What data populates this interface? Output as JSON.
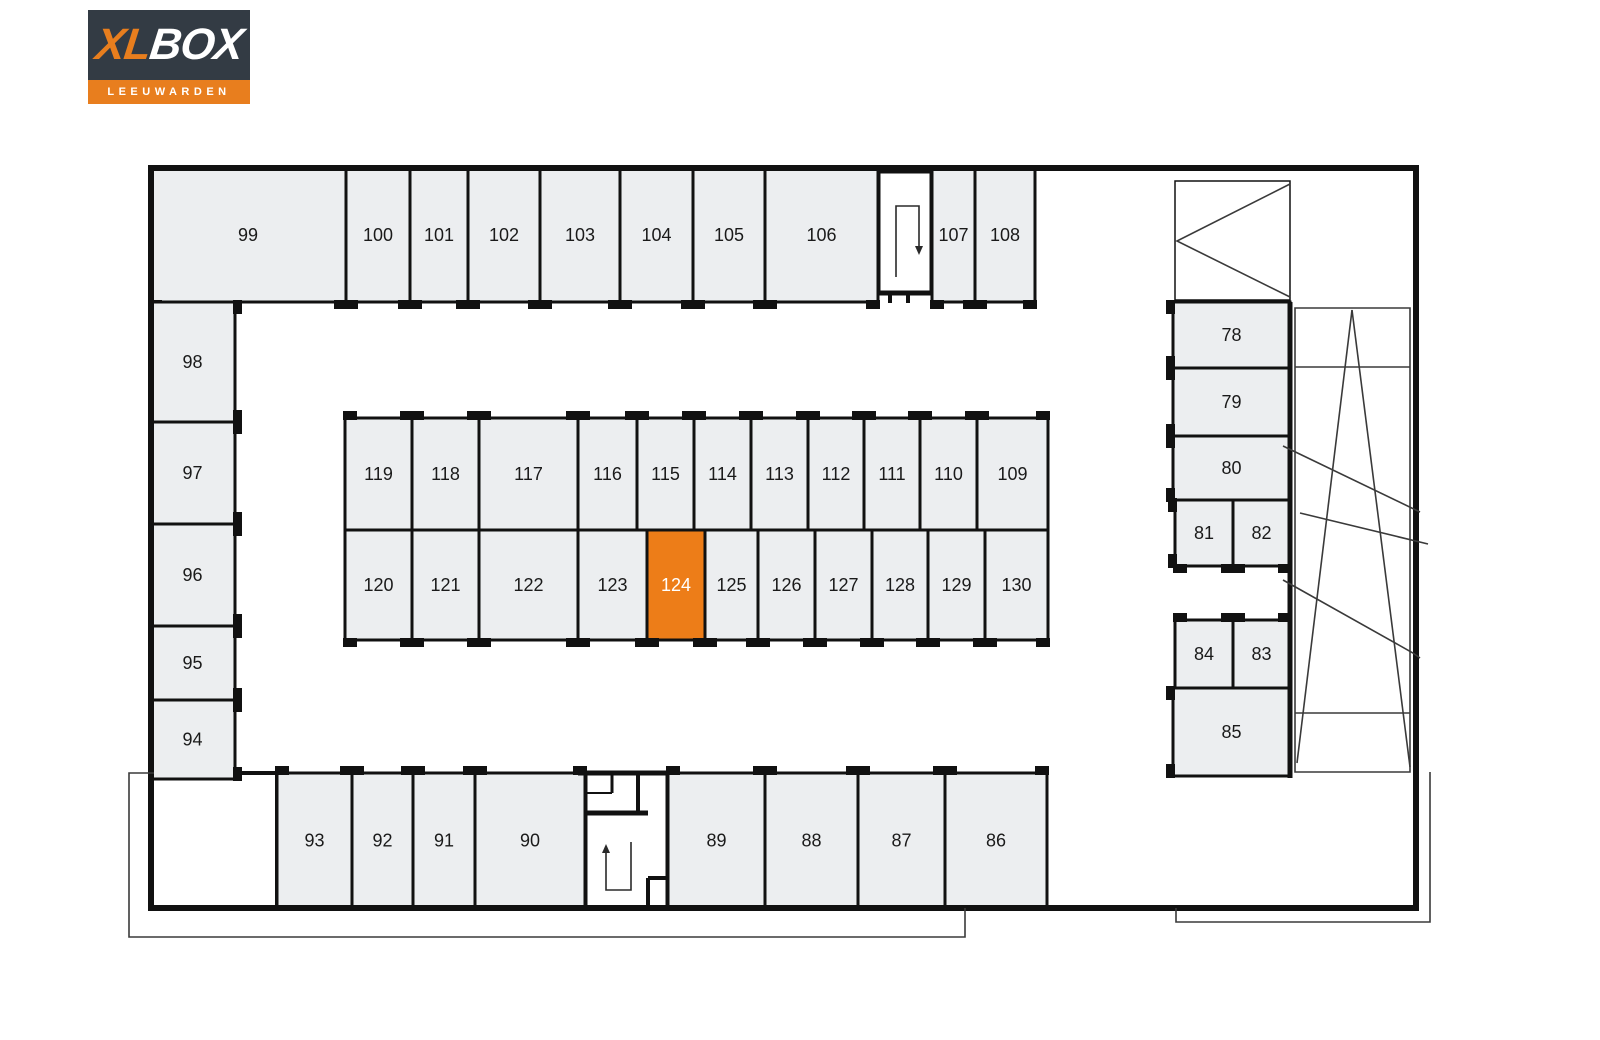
{
  "logo": {
    "xl": "XL",
    "box": "BOX",
    "city": "LEEUWARDEN",
    "dark_bg": "#333B44",
    "orange": "#E87E1E"
  },
  "colors": {
    "unit_fill": "#ECEEF0",
    "highlight_fill": "#ED7D18",
    "highlight_text": "#FFFFFF",
    "label_text": "#1A1A1A",
    "wall": "#111111",
    "thin_line": "#3A3A3A"
  },
  "highlighted_unit": "124",
  "units": [
    {
      "label": "99",
      "x": 150,
      "y": 168,
      "w": 196,
      "h": 134,
      "door": "B"
    },
    {
      "label": "100",
      "x": 346,
      "y": 168,
      "w": 64,
      "h": 134,
      "door": "B"
    },
    {
      "label": "101",
      "x": 410,
      "y": 168,
      "w": 58,
      "h": 134,
      "door": "B"
    },
    {
      "label": "102",
      "x": 468,
      "y": 168,
      "w": 72,
      "h": 134,
      "door": "B"
    },
    {
      "label": "103",
      "x": 540,
      "y": 168,
      "w": 80,
      "h": 134,
      "door": "B"
    },
    {
      "label": "104",
      "x": 620,
      "y": 168,
      "w": 73,
      "h": 134,
      "door": "B"
    },
    {
      "label": "105",
      "x": 693,
      "y": 168,
      "w": 72,
      "h": 134,
      "door": "B"
    },
    {
      "label": "106",
      "x": 765,
      "y": 168,
      "w": 113,
      "h": 134,
      "door": "B"
    },
    {
      "label": "107",
      "x": 932,
      "y": 168,
      "w": 43,
      "h": 134,
      "door": "B"
    },
    {
      "label": "108",
      "x": 975,
      "y": 168,
      "w": 60,
      "h": 134,
      "door": "B"
    },
    {
      "label": "98",
      "x": 150,
      "y": 302,
      "w": 85,
      "h": 120,
      "door": "R"
    },
    {
      "label": "97",
      "x": 150,
      "y": 422,
      "w": 85,
      "h": 102,
      "door": "R"
    },
    {
      "label": "96",
      "x": 150,
      "y": 524,
      "w": 85,
      "h": 102,
      "door": "R"
    },
    {
      "label": "95",
      "x": 150,
      "y": 626,
      "w": 85,
      "h": 74,
      "door": "R"
    },
    {
      "label": "94",
      "x": 150,
      "y": 700,
      "w": 85,
      "h": 79,
      "door": "R"
    },
    {
      "label": "119",
      "x": 345,
      "y": 418,
      "w": 67,
      "h": 112,
      "door": "T"
    },
    {
      "label": "118",
      "x": 412,
      "y": 418,
      "w": 67,
      "h": 112,
      "door": "T"
    },
    {
      "label": "117",
      "x": 479,
      "y": 418,
      "w": 99,
      "h": 112,
      "door": "T"
    },
    {
      "label": "116",
      "x": 578,
      "y": 418,
      "w": 59,
      "h": 112,
      "door": "T"
    },
    {
      "label": "115",
      "x": 637,
      "y": 418,
      "w": 57,
      "h": 112,
      "door": "T"
    },
    {
      "label": "114",
      "x": 694,
      "y": 418,
      "w": 57,
      "h": 112,
      "door": "T"
    },
    {
      "label": "113",
      "x": 751,
      "y": 418,
      "w": 57,
      "h": 112,
      "door": "T"
    },
    {
      "label": "112",
      "x": 808,
      "y": 418,
      "w": 56,
      "h": 112,
      "door": "T"
    },
    {
      "label": "111",
      "x": 864,
      "y": 418,
      "w": 56,
      "h": 112,
      "door": "T"
    },
    {
      "label": "110",
      "x": 920,
      "y": 418,
      "w": 57,
      "h": 112,
      "door": "T"
    },
    {
      "label": "109",
      "x": 977,
      "y": 418,
      "w": 71,
      "h": 112,
      "door": "T"
    },
    {
      "label": "120",
      "x": 345,
      "y": 530,
      "w": 67,
      "h": 110,
      "door": "B"
    },
    {
      "label": "121",
      "x": 412,
      "y": 530,
      "w": 67,
      "h": 110,
      "door": "B"
    },
    {
      "label": "122",
      "x": 479,
      "y": 530,
      "w": 99,
      "h": 110,
      "door": "B"
    },
    {
      "label": "123",
      "x": 578,
      "y": 530,
      "w": 69,
      "h": 110,
      "door": "B"
    },
    {
      "label": "124",
      "x": 647,
      "y": 530,
      "w": 58,
      "h": 110,
      "door": "B",
      "highlight": true
    },
    {
      "label": "125",
      "x": 705,
      "y": 530,
      "w": 53,
      "h": 110,
      "door": "B"
    },
    {
      "label": "126",
      "x": 758,
      "y": 530,
      "w": 57,
      "h": 110,
      "door": "B"
    },
    {
      "label": "127",
      "x": 815,
      "y": 530,
      "w": 57,
      "h": 110,
      "door": "B"
    },
    {
      "label": "128",
      "x": 872,
      "y": 530,
      "w": 56,
      "h": 110,
      "door": "B"
    },
    {
      "label": "129",
      "x": 928,
      "y": 530,
      "w": 57,
      "h": 110,
      "door": "B"
    },
    {
      "label": "130",
      "x": 985,
      "y": 530,
      "w": 63,
      "h": 110,
      "door": "B"
    },
    {
      "label": "93",
      "x": 277,
      "y": 773,
      "w": 75,
      "h": 135,
      "door": "T"
    },
    {
      "label": "92",
      "x": 352,
      "y": 773,
      "w": 61,
      "h": 135,
      "door": "T"
    },
    {
      "label": "91",
      "x": 413,
      "y": 773,
      "w": 62,
      "h": 135,
      "door": "T"
    },
    {
      "label": "90",
      "x": 475,
      "y": 773,
      "w": 110,
      "h": 135,
      "door": "T"
    },
    {
      "label": "89",
      "x": 668,
      "y": 773,
      "w": 97,
      "h": 135,
      "door": "T"
    },
    {
      "label": "88",
      "x": 765,
      "y": 773,
      "w": 93,
      "h": 135,
      "door": "T"
    },
    {
      "label": "87",
      "x": 858,
      "y": 773,
      "w": 87,
      "h": 135,
      "door": "T"
    },
    {
      "label": "86",
      "x": 945,
      "y": 773,
      "w": 102,
      "h": 135,
      "door": "T"
    },
    {
      "label": "78",
      "x": 1173,
      "y": 302,
      "w": 117,
      "h": 66,
      "door": "L"
    },
    {
      "label": "79",
      "x": 1173,
      "y": 368,
      "w": 117,
      "h": 68,
      "door": "L"
    },
    {
      "label": "80",
      "x": 1173,
      "y": 436,
      "w": 117,
      "h": 64,
      "door": "L"
    },
    {
      "label": "81",
      "x": 1175,
      "y": 500,
      "w": 58,
      "h": 66,
      "door": "LB"
    },
    {
      "label": "82",
      "x": 1233,
      "y": 500,
      "w": 57,
      "h": 66,
      "door": "B"
    },
    {
      "label": "84",
      "x": 1175,
      "y": 620,
      "w": 58,
      "h": 68,
      "door": "T"
    },
    {
      "label": "83",
      "x": 1233,
      "y": 620,
      "w": 57,
      "h": 68,
      "door": "T"
    },
    {
      "label": "85",
      "x": 1173,
      "y": 688,
      "w": 117,
      "h": 88,
      "door": "L"
    }
  ],
  "rooms": [
    {
      "name": "entry-room",
      "x": 151,
      "y": 773,
      "w": 126,
      "h": 135,
      "stroke": 4
    },
    {
      "name": "stairwell-top",
      "x": 878,
      "y": 171,
      "w": 54,
      "h": 122,
      "stroke": 5
    },
    {
      "name": "stairwell-bottom",
      "x": 585,
      "y": 773,
      "w": 83,
      "h": 135,
      "stroke": 5
    },
    {
      "name": "ramp-entry-box",
      "x": 1175,
      "y": 181,
      "w": 115,
      "h": 119,
      "stroke": 1.5
    }
  ],
  "walls": [
    {
      "x1": 148,
      "y1": 168,
      "x2": 1419,
      "y2": 168,
      "sw": 6
    },
    {
      "x1": 151,
      "y1": 168,
      "x2": 151,
      "y2": 908,
      "sw": 6
    },
    {
      "x1": 148,
      "y1": 908,
      "x2": 1419,
      "y2": 908,
      "sw": 6
    },
    {
      "x1": 1416,
      "y1": 168,
      "x2": 1416,
      "y2": 908,
      "sw": 6
    },
    {
      "x1": 1290,
      "y1": 302,
      "x2": 1290,
      "y2": 778,
      "sw": 5
    },
    {
      "x1": 878,
      "y1": 293,
      "x2": 890,
      "y2": 293,
      "sw": 5
    },
    {
      "x1": 908,
      "y1": 293,
      "x2": 932,
      "y2": 293,
      "sw": 5
    },
    {
      "x1": 890,
      "y1": 293,
      "x2": 890,
      "y2": 303,
      "sw": 4
    },
    {
      "x1": 908,
      "y1": 293,
      "x2": 908,
      "y2": 303,
      "sw": 4
    },
    {
      "x1": 578,
      "y1": 773,
      "x2": 668,
      "y2": 773,
      "sw": 5
    },
    {
      "x1": 612,
      "y1": 773,
      "x2": 612,
      "y2": 793,
      "sw": 3
    },
    {
      "x1": 585,
      "y1": 793,
      "x2": 612,
      "y2": 793,
      "sw": 2
    },
    {
      "x1": 638,
      "y1": 773,
      "x2": 638,
      "y2": 813,
      "sw": 4
    },
    {
      "x1": 585,
      "y1": 813,
      "x2": 648,
      "y2": 813,
      "sw": 5
    },
    {
      "x1": 648,
      "y1": 878,
      "x2": 648,
      "y2": 908,
      "sw": 4
    },
    {
      "x1": 648,
      "y1": 878,
      "x2": 668,
      "y2": 878,
      "sw": 4
    }
  ],
  "lines": [
    {
      "name": "apron-left",
      "d": "M154,773 L129,773 L129,937 L965,937 L965,908"
    },
    {
      "name": "apron-right",
      "d": "M1176,908 L1176,922 L1430,922 L1430,772"
    },
    {
      "name": "ramp-lane",
      "d": "M1295,308 H1410 V772 H1295 Z"
    },
    {
      "name": "ramp-divider-1",
      "d": "M1295,367 H1410"
    },
    {
      "name": "ramp-divider-2",
      "d": "M1295,713 H1410"
    },
    {
      "name": "ramp-slope-left",
      "d": "M1352,310 L1297,763"
    },
    {
      "name": "ramp-slope-right",
      "d": "M1352,310 L1410,767"
    },
    {
      "name": "ramp-diagonal-a",
      "d": "M1283,446 L1420,512"
    },
    {
      "name": "ramp-diagonal-b",
      "d": "M1300,513 L1428,544"
    },
    {
      "name": "ramp-diagonal-c",
      "d": "M1283,580 L1413,653 L1420,658"
    },
    {
      "name": "ramp-chevron",
      "d": "M1290,184 L1177,241 L1290,297"
    }
  ],
  "arrows": [
    {
      "name": "stairs-down-arrow",
      "d": "M896,277 L896,206 L919,206 L919,246",
      "head": "915,246 923,246 919,255"
    },
    {
      "name": "stairs-up-arrow",
      "d": "M606,852 L606,890 L631,890 L631,842",
      "head": "602,853 610,853 606,844"
    }
  ]
}
